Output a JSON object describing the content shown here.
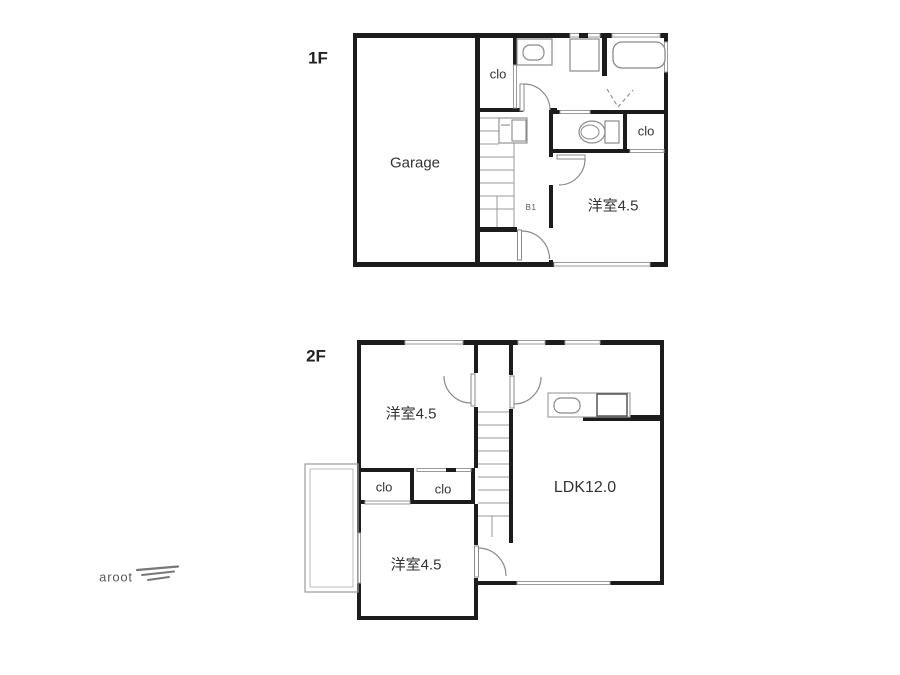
{
  "floor1": {
    "label": "1F",
    "rooms": {
      "garage": "Garage",
      "closet_top": "clo",
      "closet_side": "clo",
      "western_room": "洋室4.5",
      "hall_note": "B1"
    }
  },
  "floor2": {
    "label": "2F",
    "rooms": {
      "western_room_top": "洋室4.5",
      "closet_left": "clo",
      "closet_right": "clo",
      "ldk": "LDK12.0",
      "western_room_bottom": "洋室4.5"
    }
  },
  "footer": {
    "brand": "aroot",
    "logo_icon": "triple-lines-icon"
  },
  "colors": {
    "wall": "#1c1c1c",
    "fixture_line": "#8a8a8a",
    "window_line": "#9a9a9a",
    "text": "#2b2b2b",
    "brand_text": "#5a5a5a"
  }
}
